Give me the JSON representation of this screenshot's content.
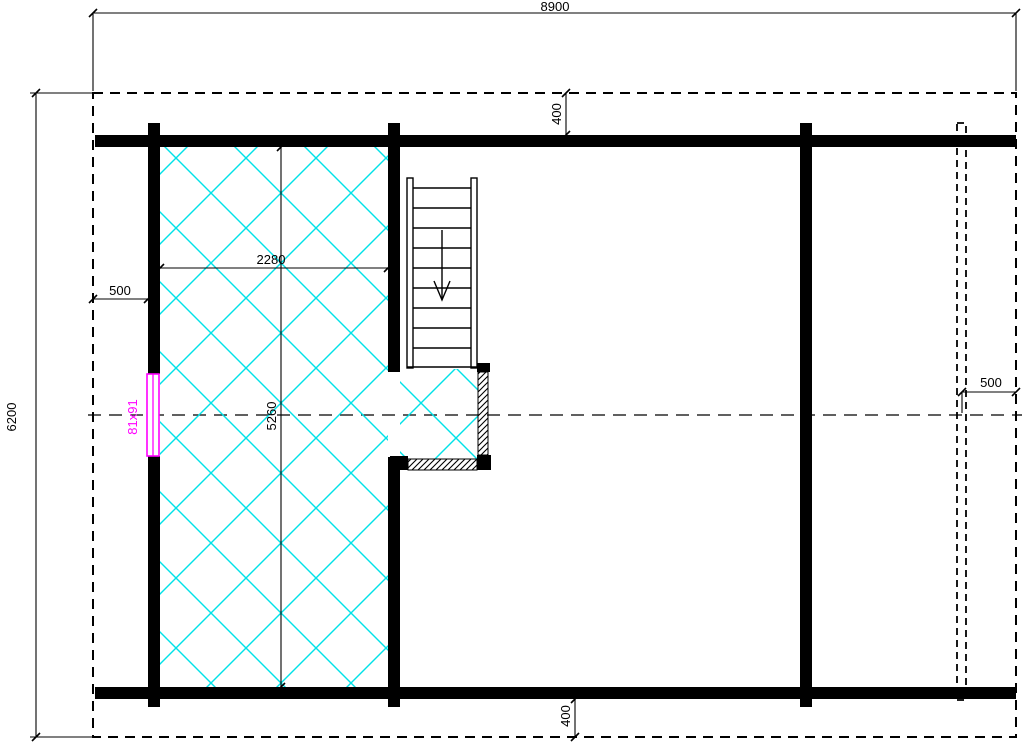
{
  "dimensions": {
    "overall_width": "8900",
    "overall_depth": "6200",
    "roof_offset_top": "400",
    "roof_offset_bottom": "400",
    "side_offset_left": "500",
    "side_offset_right": "500",
    "loft_floor_width": "2280",
    "loft_floor_depth": "5260"
  },
  "window": {
    "size_label": "81x91"
  },
  "stairs": {
    "tread_count": 9
  },
  "colors": {
    "line": "#000000",
    "floor_hatch": "#00e2e8",
    "window_marker": "#ff00ff",
    "background": "#ffffff"
  }
}
